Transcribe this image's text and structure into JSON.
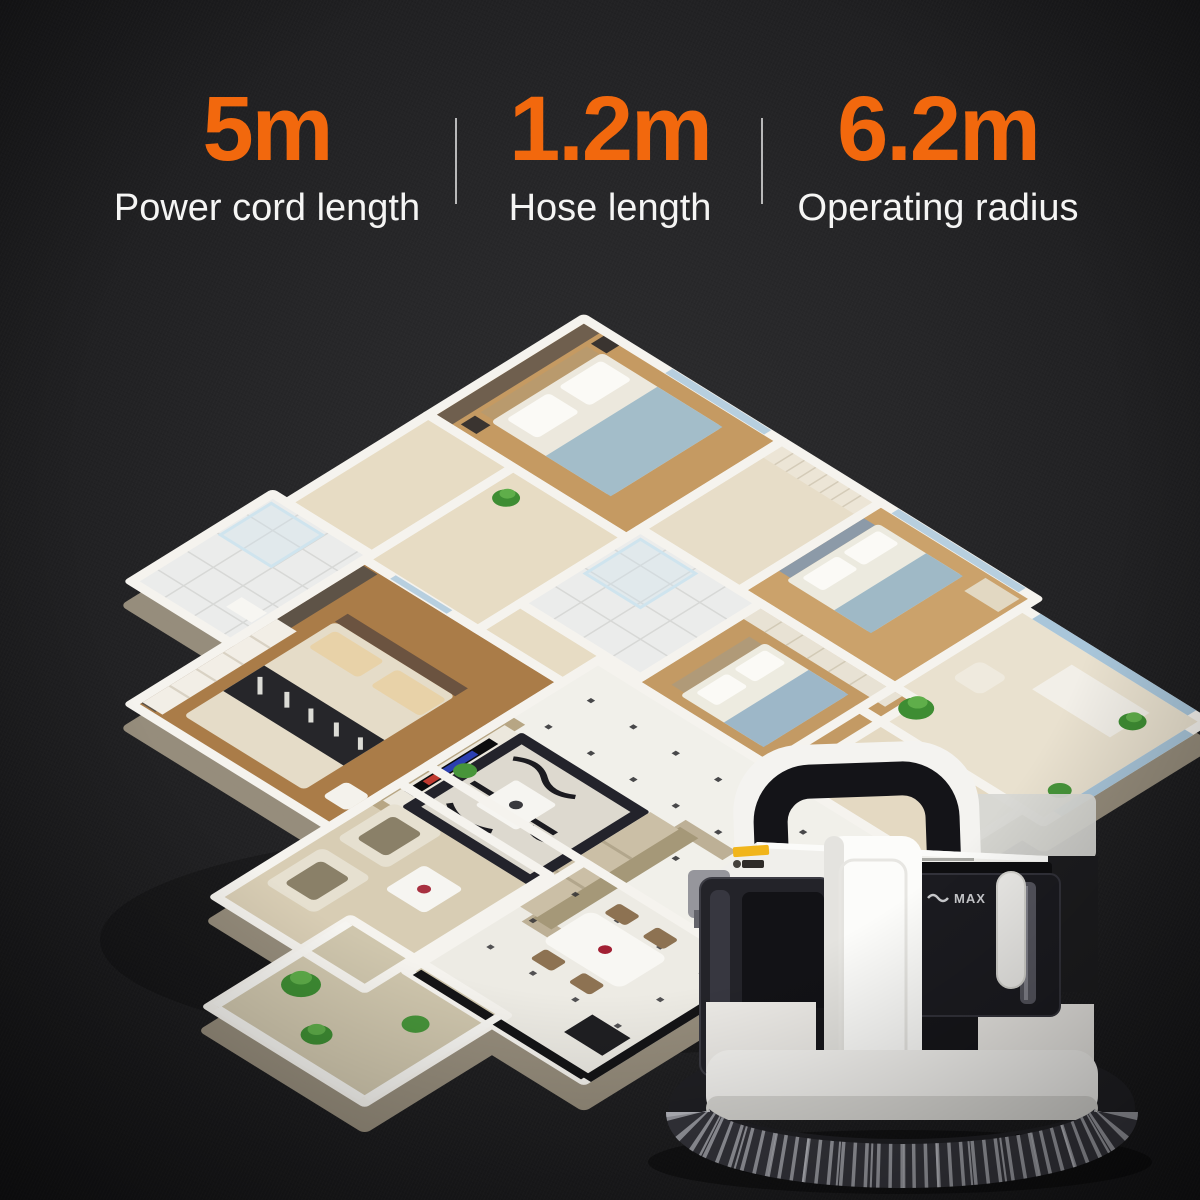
{
  "stats": {
    "items": [
      {
        "value": "5m",
        "label": "Power cord length"
      },
      {
        "value": "1.2m",
        "label": "Hose length"
      },
      {
        "value": "6.2m",
        "label": "Operating radius"
      }
    ]
  },
  "product": {
    "tank_max_label": "MAX"
  },
  "colors": {
    "accent_orange": "#f2680d",
    "background_dark": "#1e1e20",
    "stat_label_text": "#f5f5f4",
    "divider": "#ffffff",
    "machine_body_white": "#f4f3f0",
    "machine_dark": "#17171a",
    "hose_gray": "#9b9ca3",
    "warning_label_yellow": "#f0b414",
    "wall_top_white": "#f5f3ee",
    "window_blue": "#aac6dc"
  }
}
